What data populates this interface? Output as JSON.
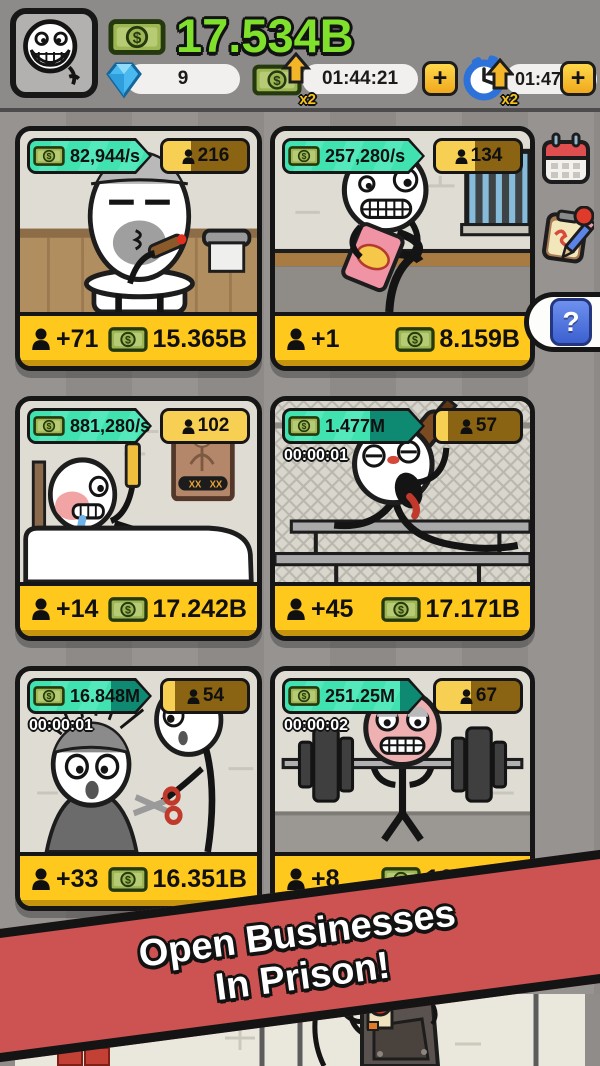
{
  "header": {
    "balance": "17.534B",
    "gems": "9",
    "boosters": [
      {
        "multiplier": "x2",
        "timer": "01:44:21",
        "plus": "+"
      },
      {
        "multiplier": "x2",
        "timer": "01:47:55",
        "plus": "+"
      }
    ]
  },
  "side_buttons": {
    "help_label": "?"
  },
  "cards": [
    {
      "rate": "82,944/s",
      "workers": "216",
      "timer": "",
      "hire": "+71",
      "price": "15.365B",
      "rate_fill": "width:100%",
      "worker_fill": "width:33%"
    },
    {
      "rate": "257,280/s",
      "workers": "134",
      "timer": "",
      "hire": "+1",
      "price": "8.159B",
      "rate_fill": "width:100%",
      "worker_fill": "width:46%"
    },
    {
      "rate": "881,280/s",
      "workers": "102",
      "timer": "",
      "hire": "+14",
      "price": "17.242B",
      "rate_fill": "width:100%",
      "worker_fill": "width:100%"
    },
    {
      "rate": "1.477M",
      "workers": "57",
      "timer": "00:00:01",
      "hire": "+45",
      "price": "17.171B",
      "rate_fill": "width:62%",
      "worker_fill": "width:14%"
    },
    {
      "rate": "16.848M",
      "workers": "54",
      "timer": "00:00:01",
      "hire": "+33",
      "price": "16.351B",
      "rate_fill": "width:68%",
      "worker_fill": "width:14%"
    },
    {
      "rate": "251.25M",
      "workers": "67",
      "timer": "00:00:02",
      "hire": "+8",
      "price": "16.129B",
      "rate_fill": "width:84%",
      "worker_fill": "width:42%"
    }
  ],
  "banner": {
    "line1": "Open Businesses",
    "line2": "In Prison!"
  }
}
